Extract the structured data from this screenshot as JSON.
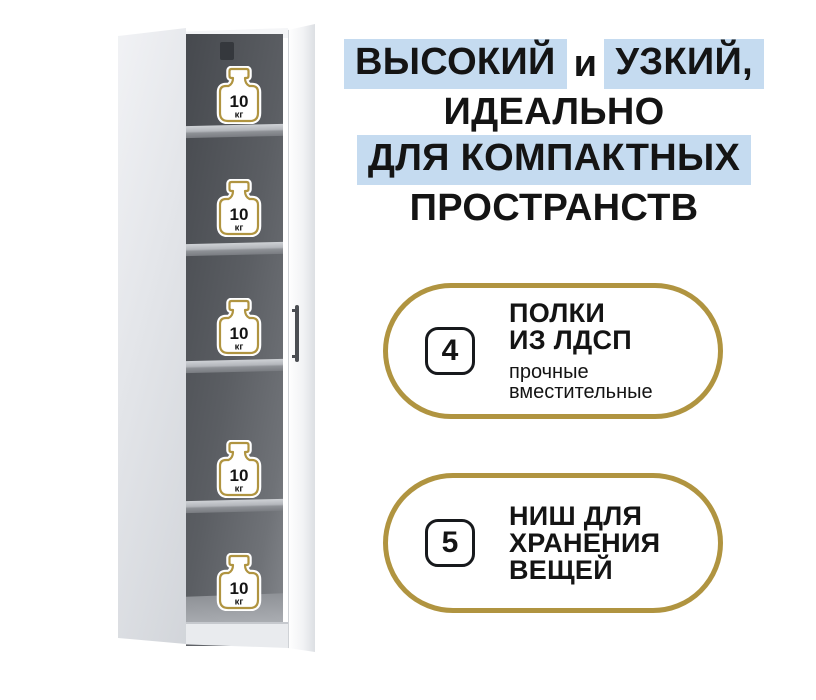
{
  "colors": {
    "accent_gold": "#b09440",
    "highlight_blue": "#c5dbf0",
    "text_dark": "#141414"
  },
  "headline": {
    "line1": {
      "hl1": "ВЫСОКИЙ",
      "mid": "и",
      "hl2": "УЗКИЙ,"
    },
    "line2": "ИДЕАЛЬНО",
    "line3": "ДЛЯ КОМПАКТНЫХ",
    "line4": "ПРОСТРАНСТВ"
  },
  "features": [
    {
      "number": "4",
      "title1": "ПОЛКИ",
      "title2": "ИЗ ЛДСП",
      "sub1": "прочные",
      "sub2": "вместительные"
    },
    {
      "number": "5",
      "title1": "НИШ ДЛЯ",
      "title2": "ХРАНЕНИЯ",
      "title3": "ВЕЩЕЙ"
    }
  ],
  "cabinet": {
    "niche_count": 5,
    "weight_value": "10",
    "weight_unit": "кг"
  }
}
